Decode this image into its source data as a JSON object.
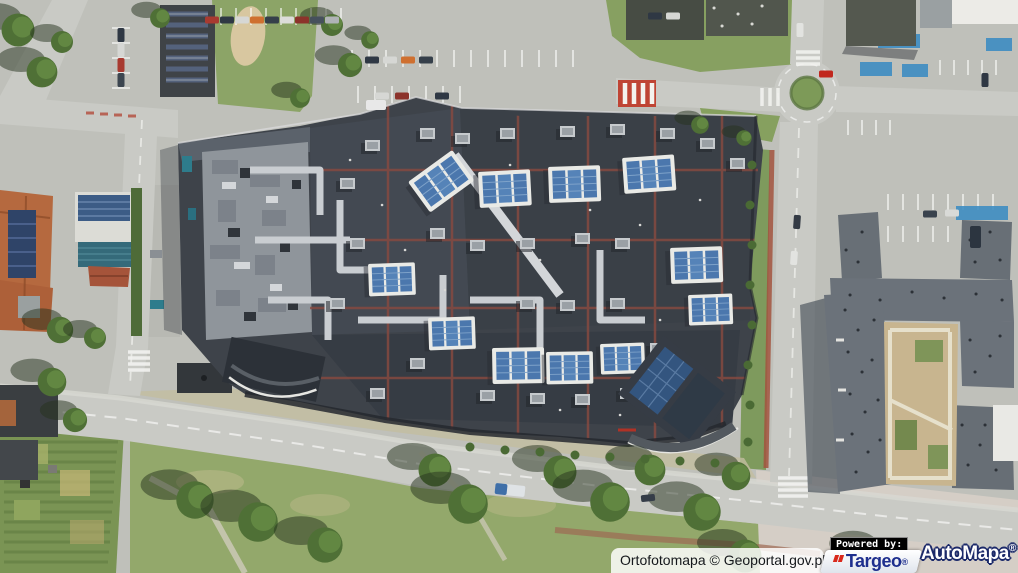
{
  "map_viewer": {
    "canvas": {
      "type": "orthophoto",
      "scene_description": "aerial orthophoto: large shopping mall with dark flat roof, red roof walkway lines, skylights and blue solar panels; ring road with roundabout, parking lots with cars, apartment complex with courtyard garden, orange-roofed buildings, allotment gardens, tree-lined avenue"
    },
    "attribution": {
      "text": "Ortofotomapa © Geoportal.gov.pl"
    },
    "branding": {
      "powered_by_label": "Powered by:",
      "targeo": {
        "name": "Targeo",
        "registered_mark": "®",
        "blue": "#1e2f8e",
        "red": "#d9291c"
      },
      "automapa": {
        "name": "AutoMapa",
        "registered_mark": "®",
        "text_color": "#ffffff",
        "outline_color": "#1c2a6a"
      }
    },
    "palette": {
      "ground": "#bfc0ba",
      "road": "#c9cac5",
      "mall_roof_dark": "#3e434a",
      "mall_roof_light": "#959aa0",
      "solar_blue": "#4b77ad",
      "grass": "#8aa264",
      "tree": "#4f7036",
      "roof_line_red": "#8a4a40",
      "right_building": "#6b727a",
      "orange_roof": "#b5693f",
      "courtyard": "#c8b58f"
    }
  }
}
